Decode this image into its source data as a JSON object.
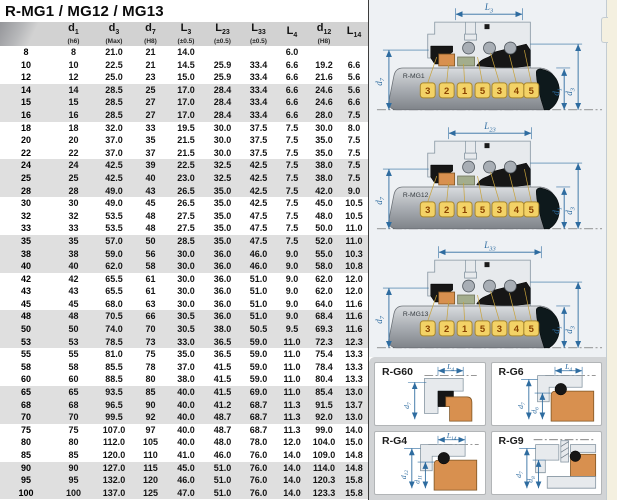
{
  "title": "R-MG1 / MG12 / MG13",
  "table": {
    "columns": [
      {
        "base": "",
        "sub": "",
        "note": ""
      },
      {
        "base": "d",
        "sub": "1",
        "note": "(h6)"
      },
      {
        "base": "d",
        "sub": "3",
        "note": "(Max)"
      },
      {
        "base": "d",
        "sub": "7",
        "note": "(H8)"
      },
      {
        "base": "L",
        "sub": "3",
        "note": "(±0.5)"
      },
      {
        "base": "L",
        "sub": "23",
        "note": "(±0.5)"
      },
      {
        "base": "L",
        "sub": "33",
        "note": "(±0.5)"
      },
      {
        "base": "L",
        "sub": "4",
        "note": ""
      },
      {
        "base": "d",
        "sub": "12",
        "note": "(H8)"
      },
      {
        "base": "L",
        "sub": "14",
        "note": ""
      }
    ],
    "rows": [
      [
        "8",
        "8",
        "21.0",
        "21",
        "14.0",
        "",
        "",
        "6.0",
        "",
        ""
      ],
      [
        "10",
        "10",
        "22.5",
        "21",
        "14.5",
        "25.9",
        "33.4",
        "6.6",
        "19.2",
        "6.6"
      ],
      [
        "12",
        "12",
        "25.0",
        "23",
        "15.0",
        "25.9",
        "33.4",
        "6.6",
        "21.6",
        "5.6"
      ],
      [
        "14",
        "14",
        "28.5",
        "25",
        "17.0",
        "28.4",
        "33.4",
        "6.6",
        "24.6",
        "5.6"
      ],
      [
        "15",
        "15",
        "28.5",
        "27",
        "17.0",
        "28.4",
        "33.4",
        "6.6",
        "24.6",
        "6.6"
      ],
      [
        "16",
        "16",
        "28.5",
        "27",
        "17.0",
        "28.4",
        "33.4",
        "6.6",
        "28.0",
        "7.5"
      ],
      [
        "18",
        "18",
        "32.0",
        "33",
        "19.5",
        "30.0",
        "37.5",
        "7.5",
        "30.0",
        "8.0"
      ],
      [
        "20",
        "20",
        "37.0",
        "35",
        "21.5",
        "30.0",
        "37.5",
        "7.5",
        "35.0",
        "7.5"
      ],
      [
        "22",
        "22",
        "37.0",
        "37",
        "21.5",
        "30.0",
        "37.5",
        "7.5",
        "35.0",
        "7.5"
      ],
      [
        "24",
        "24",
        "42.5",
        "39",
        "22.5",
        "32.5",
        "42.5",
        "7.5",
        "38.0",
        "7.5"
      ],
      [
        "25",
        "25",
        "42.5",
        "40",
        "23.0",
        "32.5",
        "42.5",
        "7.5",
        "38.0",
        "7.5"
      ],
      [
        "28",
        "28",
        "49.0",
        "43",
        "26.5",
        "35.0",
        "42.5",
        "7.5",
        "42.0",
        "9.0"
      ],
      [
        "30",
        "30",
        "49.0",
        "45",
        "26.5",
        "35.0",
        "42.5",
        "7.5",
        "45.0",
        "10.5"
      ],
      [
        "32",
        "32",
        "53.5",
        "48",
        "27.5",
        "35.0",
        "47.5",
        "7.5",
        "48.0",
        "10.5"
      ],
      [
        "33",
        "33",
        "53.5",
        "48",
        "27.5",
        "35.0",
        "47.5",
        "7.5",
        "50.0",
        "11.0"
      ],
      [
        "35",
        "35",
        "57.0",
        "50",
        "28.5",
        "35.0",
        "47.5",
        "7.5",
        "52.0",
        "11.0"
      ],
      [
        "38",
        "38",
        "59.0",
        "56",
        "30.0",
        "36.0",
        "46.0",
        "9.0",
        "55.0",
        "10.3"
      ],
      [
        "40",
        "40",
        "62.0",
        "58",
        "30.0",
        "36.0",
        "46.0",
        "9.0",
        "58.0",
        "10.8"
      ],
      [
        "42",
        "42",
        "65.5",
        "61",
        "30.0",
        "36.0",
        "51.0",
        "9.0",
        "62.0",
        "12.0"
      ],
      [
        "43",
        "43",
        "65.5",
        "61",
        "30.0",
        "36.0",
        "51.0",
        "9.0",
        "62.0",
        "12.0"
      ],
      [
        "45",
        "45",
        "68.0",
        "63",
        "30.0",
        "36.0",
        "51.0",
        "9.0",
        "64.0",
        "11.6"
      ],
      [
        "48",
        "48",
        "70.5",
        "66",
        "30.5",
        "36.0",
        "51.0",
        "9.0",
        "68.4",
        "11.6"
      ],
      [
        "50",
        "50",
        "74.0",
        "70",
        "30.5",
        "38.0",
        "50.5",
        "9.5",
        "69.3",
        "11.6"
      ],
      [
        "53",
        "53",
        "78.5",
        "73",
        "33.0",
        "36.5",
        "59.0",
        "11.0",
        "72.3",
        "12.3"
      ],
      [
        "55",
        "55",
        "81.0",
        "75",
        "35.0",
        "36.5",
        "59.0",
        "11.0",
        "75.4",
        "13.3"
      ],
      [
        "58",
        "58",
        "85.5",
        "78",
        "37.0",
        "41.5",
        "59.0",
        "11.0",
        "78.4",
        "13.3"
      ],
      [
        "60",
        "60",
        "88.5",
        "80",
        "38.0",
        "41.5",
        "59.0",
        "11.0",
        "80.4",
        "13.3"
      ],
      [
        "65",
        "65",
        "93.5",
        "85",
        "40.0",
        "41.5",
        "69.0",
        "11.0",
        "85.4",
        "13.0"
      ],
      [
        "68",
        "68",
        "96.5",
        "90",
        "40.0",
        "41.2",
        "68.7",
        "11.3",
        "91.5",
        "13.7"
      ],
      [
        "70",
        "70",
        "99.5",
        "92",
        "40.0",
        "48.7",
        "68.7",
        "11.3",
        "92.0",
        "13.0"
      ],
      [
        "75",
        "75",
        "107.0",
        "97",
        "40.0",
        "48.7",
        "68.7",
        "11.3",
        "99.0",
        "14.0"
      ],
      [
        "80",
        "80",
        "112.0",
        "105",
        "40.0",
        "48.0",
        "78.0",
        "12.0",
        "104.0",
        "15.0"
      ],
      [
        "85",
        "85",
        "120.0",
        "110",
        "41.0",
        "46.0",
        "76.0",
        "14.0",
        "109.0",
        "14.8"
      ],
      [
        "90",
        "90",
        "127.0",
        "115",
        "45.0",
        "51.0",
        "76.0",
        "14.0",
        "114.0",
        "14.8"
      ],
      [
        "95",
        "95",
        "132.0",
        "120",
        "46.0",
        "51.0",
        "76.0",
        "14.0",
        "120.3",
        "15.8"
      ],
      [
        "100",
        "100",
        "137.0",
        "125",
        "47.0",
        "51.0",
        "76.0",
        "14.0",
        "123.3",
        "15.8"
      ]
    ]
  },
  "seal_diagrams": [
    {
      "name": "R-MG1",
      "length_label": {
        "base": "L",
        "sub": "3"
      },
      "left_label": {
        "base": "d",
        "sub": "7"
      },
      "right_labels": [
        {
          "base": "d",
          "sub": "1"
        },
        {
          "base": "d",
          "sub": "3"
        }
      ],
      "part_tags": [
        "3",
        "2",
        "1",
        "5",
        "3",
        "4",
        "5"
      ]
    },
    {
      "name": "R-MG12",
      "length_label": {
        "base": "L",
        "sub": "23"
      },
      "left_label": {
        "base": "d",
        "sub": "7"
      },
      "right_labels": [
        {
          "base": "d",
          "sub": "1"
        },
        {
          "base": "d",
          "sub": "3"
        }
      ],
      "part_tags": [
        "3",
        "2",
        "1",
        "5",
        "3",
        "4",
        "5"
      ]
    },
    {
      "name": "R-MG13",
      "length_label": {
        "base": "L",
        "sub": "33"
      },
      "left_label": {
        "base": "d",
        "sub": "7"
      },
      "right_labels": [
        {
          "base": "d",
          "sub": "1"
        },
        {
          "base": "d",
          "sub": "3"
        }
      ],
      "part_tags": [
        "3",
        "2",
        "1",
        "5",
        "3",
        "4",
        "5"
      ]
    }
  ],
  "seat_panels": [
    {
      "name": "R-G60",
      "top_label": {
        "base": "L",
        "sub": "4"
      },
      "left_labels": [
        {
          "base": "d",
          "sub": "7"
        }
      ]
    },
    {
      "name": "R-G6",
      "top_label": {
        "base": "L",
        "sub": "4"
      },
      "left_labels": [
        {
          "base": "d",
          "sub": "7"
        },
        {
          "base": "d",
          "sub": "6"
        }
      ]
    },
    {
      "name": "R-G4",
      "top_label": {
        "base": "L",
        "sub": "14"
      },
      "left_labels": [
        {
          "base": "d",
          "sub": "12"
        },
        {
          "base": "d",
          "sub": "11"
        }
      ]
    },
    {
      "name": "R-G9",
      "top_label": null,
      "left_labels": [
        {
          "base": "d",
          "sub": "7"
        },
        {
          "base": "d",
          "sub": "8"
        }
      ]
    }
  ],
  "colors": {
    "dim_blue": "#2e6ca0",
    "tag_gold": "#f3d266",
    "tag_border": "#a8872e",
    "tag_text": "#8a4200",
    "seal_orange": "#d8904f",
    "seal_olive": "#a3ad8d",
    "row_alt": "#dfdfdf",
    "header_gray": "#d2d2d2",
    "edge_cream": "#f4f0e0"
  }
}
